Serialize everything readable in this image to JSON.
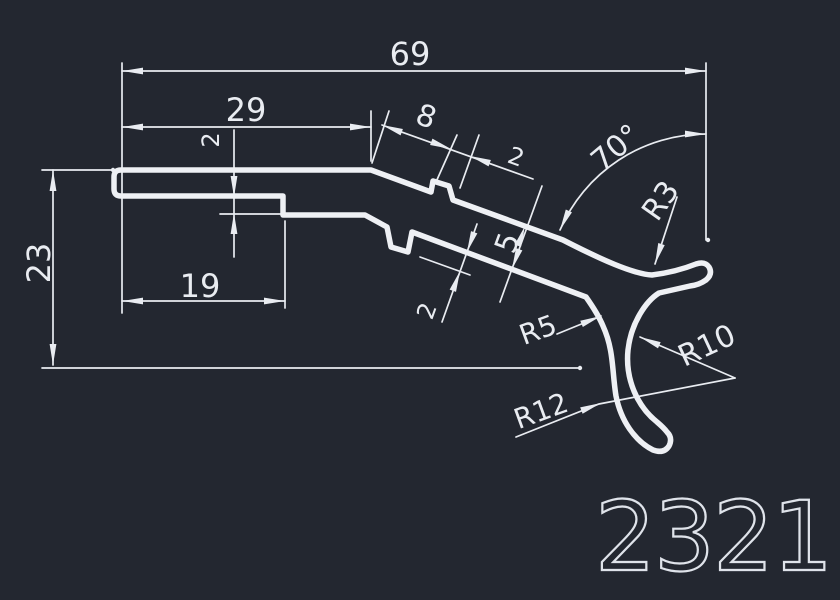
{
  "colors": {
    "background": "#232730",
    "line": "#e9ecf1"
  },
  "part_number": "2321",
  "dimensions": {
    "overall_width": "69",
    "upper_length": "29",
    "step": "2",
    "rib_offset": "8",
    "rib_width": "2",
    "angle": "70°",
    "radius_tip": "R3",
    "overall_height": "23",
    "lower_length": "19",
    "wall_thickness": "5",
    "rib_depth": "2",
    "radius_fillet": "R5",
    "radius_hook_inner": "R10",
    "radius_hook_outer": "R12"
  }
}
